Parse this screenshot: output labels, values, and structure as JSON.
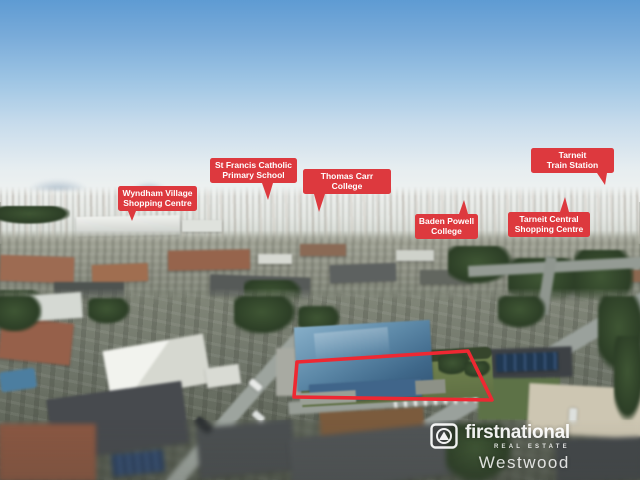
{
  "labels": [
    {
      "line1": "Wyndham Village",
      "line2": "Shopping Centre"
    },
    {
      "line1": "St Francis Catholic",
      "line2": "Primary School"
    },
    {
      "line1": "Thomas Carr",
      "line2": "College"
    },
    {
      "line1": "Baden Powell",
      "line2": "College"
    },
    {
      "line1": "Tarneit",
      "line2": "Train Station"
    },
    {
      "line1": "Tarneit Central",
      "line2": "Shopping Centre"
    }
  ],
  "logo": {
    "brand": "firstnational",
    "tagline": "REAL ESTATE",
    "office": "Westwood"
  },
  "colors": {
    "label_red": "#dd393e",
    "outline_red": "#ee2832",
    "sky_top": "#5e9bd3",
    "sky_horizon": "#f1f3f1"
  }
}
